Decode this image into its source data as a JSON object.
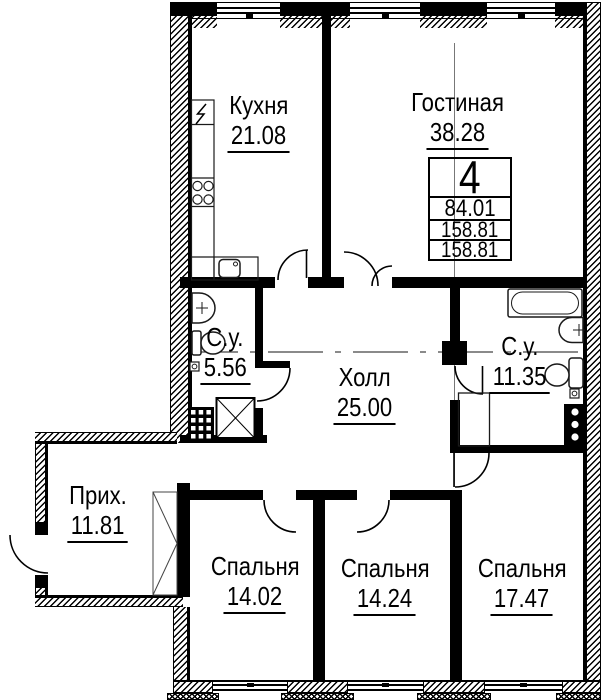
{
  "plan": {
    "title": "apartment-floor-plan",
    "rooms": [
      {
        "id": "kitchen",
        "name": "Кухня",
        "area": "21.08"
      },
      {
        "id": "living-room",
        "name": "Гостиная",
        "area": "38.28"
      },
      {
        "id": "bath-small",
        "name": "С.у.",
        "area": "5.56"
      },
      {
        "id": "hall",
        "name": "Холл",
        "area": "25.00"
      },
      {
        "id": "bath-large",
        "name": "С.у.",
        "area": "11.35"
      },
      {
        "id": "entry",
        "name": "Прих.",
        "area": "11.81"
      },
      {
        "id": "bedroom-1",
        "name": "Спальня",
        "area": "14.02"
      },
      {
        "id": "bedroom-2",
        "name": "Спальня",
        "area": "14.24"
      },
      {
        "id": "bedroom-3",
        "name": "Спальня",
        "area": "17.47"
      }
    ],
    "info_table": {
      "apartment_number": "4",
      "rows": [
        "84.01",
        "158.81",
        "158.81"
      ]
    },
    "fixtures": [
      "bathtub-icon",
      "sink-icon",
      "toilet-icon",
      "stove-icon",
      "kitchen-sink-icon",
      "electric-panel-icon",
      "wardrobe-icon",
      "vent-shaft-icon",
      "duct-shaft-icon"
    ],
    "colors": {
      "wall": "#000000",
      "background": "#ffffff",
      "thin_line": "#444444"
    }
  }
}
